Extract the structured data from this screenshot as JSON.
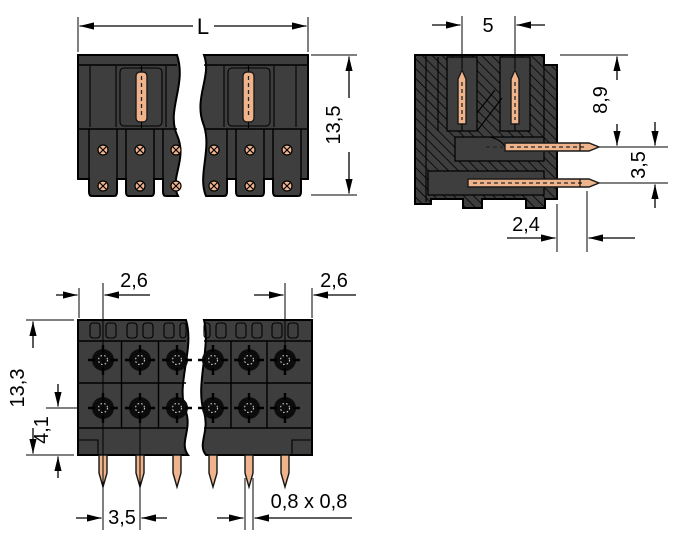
{
  "drawing": {
    "type": "technical dimensional drawing of a PCB pin header connector",
    "views": {
      "front": {
        "label": "front-view",
        "dim_length": "L",
        "dim_height": "13,5"
      },
      "side": {
        "label": "side-section-view",
        "dim_pin_spacing": "5",
        "dim_pin_height": "8,9",
        "dim_row_offset": "3,5",
        "dim_edge_offset": "2,4"
      },
      "top": {
        "label": "top-view",
        "dim_margin_left": "2,6",
        "dim_margin_right": "2,6",
        "dim_depth": "13,3",
        "dim_row_inset": "4,1",
        "dim_pin_pitch": "3,5",
        "dim_pin_section": "0,8 x 0,8"
      }
    },
    "colors": {
      "background": "#ffffff",
      "housing_gray": "#3e3e3e",
      "outline_black": "#000000",
      "pin_copper": "#efb48c",
      "contact_black": "#0c0c0c"
    }
  }
}
